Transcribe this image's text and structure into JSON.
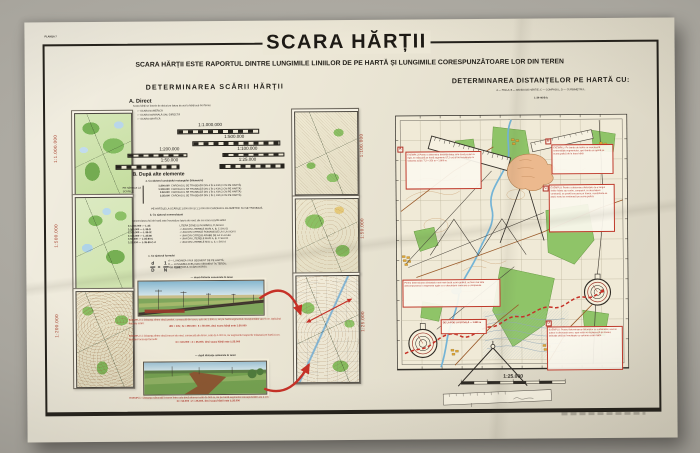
{
  "plate_label": "PLANȘA 7",
  "title": "SCARA HĂRȚII",
  "subtitle": "SCARA HĂRȚII ESTE RAPORTUL DINTRE LUNGIMILE LINIILOR DE PE HARTĂ ȘI LUNGIMILE CORESPUNZĂTOARE LOR DIN TEREN",
  "colors": {
    "accent_red": "#b03226",
    "forest_green": "#8fc468",
    "village_orange": "#e2a733",
    "river_blue": "#74b4d6",
    "paper": "#ece7d6"
  },
  "left": {
    "heading": "DETERMINAREA SCĂRII HĂRȚII",
    "side_left": [
      "1:1.000.000",
      "1:500.000",
      "1:200.000"
    ],
    "side_right": [
      "1:100.000",
      "1:50.000",
      "1:25.000"
    ],
    "a": {
      "title": "A. Direct",
      "intro": "Scara hărții se înscrie de obicei pe latura de sud a hărții sub trei forme:",
      "bullets": [
        "— SCARA NUMERICĂ",
        "— SCARA NOMINALĂ SAU DIRECTĂ",
        "— SCARA GRAFICĂ"
      ],
      "scales": [
        "1:1.000.000",
        "1:500.000",
        "1:200.000",
        "1:100.000",
        "1:50.000",
        "1:25.000"
      ]
    },
    "b": {
      "title": "B. După alte elemente",
      "a_title": "a. Cu ajutorul caroiajului rectangular (kilometric)",
      "bracket": "PE HĂRȚILE LA SCĂRILE:",
      "rows": [
        {
          "scale": "1:200.000",
          "text": "CAROIAJUL SE TRASEAZĂ DIN 4 ÎN 4 KM (2 CM PE HARTĂ)"
        },
        {
          "scale": "1:100.000",
          "text": "CAROIAJUL SE TRASEAZĂ DIN 2 ÎN 2 KM (2 CM PE HARTĂ)"
        },
        {
          "scale": "1:50.000",
          "text": "CAROIAJUL SE TRASEAZĂ DIN 1 ÎN 1 KM (2 CM PE HARTĂ)"
        },
        {
          "scale": "1:25.000",
          "text": "CAROIAJUL SE TRASEAZĂ DIN 1 ÎN 1 KM (4 CM PE HARTĂ)"
        }
      ],
      "note": "PE HĂRȚILE LA SCĂRILE 1:500.000 ȘI 1:1.000.000 CAROIAJUL KILOMETRIC NU SE TRASEAZĂ",
      "b_title": "b. Cu ajutorul nomenclaturii",
      "b_note": "Nomenclatura foii de hartă este înscrisă pe latura de nord; din ea scara rezultă astfel:",
      "nrows": [
        {
          "left": "1:1.000.000 — L-35",
          "desc": "LITERA ZONEI ȘI NUMĂRUL FUSULUI"
        },
        {
          "left": "1:500.000 — L-35-D",
          "desc": "+ UNA DIN LITERELE MARI A, B, C SAU D"
        },
        {
          "left": "1:200.000 — L-35-IX",
          "desc": "+ UNA DIN CIFRELE ROMANE DE LA I LA XXXVI"
        },
        {
          "left": "1:100.000 — L-35-80",
          "desc": "+ UNA DIN CIFRELE ARABE DE LA 1 LA 144"
        },
        {
          "left": "1:50.000 — L-35-80-C",
          "desc": "+ UNA DIN LITERELE MARI A, B, C SAU D"
        },
        {
          "left": "1:25.000 — L-35-80-C-d",
          "desc": "+ UNA DIN LITERELE MICI a, b, c SAU d"
        }
      ],
      "c_title": "c. Cu ajutorul formulei",
      "f": {
        "num": "d",
        "den": "D",
        "eq": "=",
        "num2": "1",
        "den2": "N",
        "rest": "în care:"
      },
      "legend": [
        "d — LUNGIMEA UNUI SEGMENT DE PE HARTĂ;",
        "D — LUNGIMEA ACELUIAȘI SEGMENT ÎN TEREN;",
        "N — NUMITORUL SCĂRII HĂRȚII."
      ]
    },
    "known_heading": "— după distanțe cunoscute în teren",
    "ex1": {
      "text": "EXEMPLU 1: Distanța dintre două poduri, cunoscută din teren, este de 2.500 m, iar pe hartă segmentul corespunzător are 5 cm. Aplicând formula scării:",
      "formula": "d/D = 1/N ;  N = 250.000 : 5 = 50.000, deci scara hărții este 1:50.000"
    },
    "ex2": {
      "text": "EXEMPLU 2: Distanța dintre două treceri de nivel, cunoscută din teren, este de 1.000 m, iar segmentul respectiv măsoară pe hartă 4 cm. Aplicând aceeași formulă:",
      "formula": "N = 100.000 : 4 = 25.000, deci scara hărții este 1:25.000"
    },
    "measured_heading": "— după distanțe măsurate în teren",
    "exm": {
      "text": "EXEMPLU: Distanța măsurată în teren între cele două drumuri este de 500 m, iar pe hartă segmentul corespunzător are 2 cm:",
      "formula": "N = 50.000 : 2 = 25.000, deci scara hărții este 1:25.000"
    }
  },
  "right": {
    "heading": "DETERMINAREA DISTANȚELOR PE HARTĂ CU:",
    "legend": "A — RIGLA;   B — BANDA DE HÂRTIE;   C — COMPASUL;   D — CURBIMETRUL.",
    "sheet_code": "L-34-46-B-b",
    "markers": {
      "a": "A",
      "b": "B",
      "c": "C",
      "d": "D"
    },
    "map_scale": "1:25.000",
    "boxes": {
      "a": "EXEMPLU: Pentru a determina distanța dintre cele două poduri cu rigla, se măsoară pe hartă segmentul (7,2 cm) și se înmulțește cu valoarea scării: 7,2 × 250 m = 1.800 m.",
      "b": "EXEMPLU: Pe banda de hârtie se marchează extremitățile segmentului, apoi banda se aplică pe scara grafică de la baza hărții.",
      "c": "EXEMPLU: Pentru a determina distanțele de-a lungul liniilor frânte sau curbe, compasul, cu deschidere constantă, se poartă succesiv pe traseu, numărându-se pașii; restul se evaluează pe scara grafică.",
      "d": "Pentru determinarea distanțelor mai mari decât scara grafică, se face mai întâi descompunerea în segmente egale cu o deschidere oarecare a compasului.",
      "small": "DE LA POD LA ȘCOALĂ — 1.850 m",
      "e": "EXEMPLU: Pentru determinarea distanțelor cu curbimetrul, acul se aduce la diviziunea zero, apoi rotița se deplasează pe traseu; indicația citită se înmulțește cu valoarea scării hărții."
    }
  }
}
